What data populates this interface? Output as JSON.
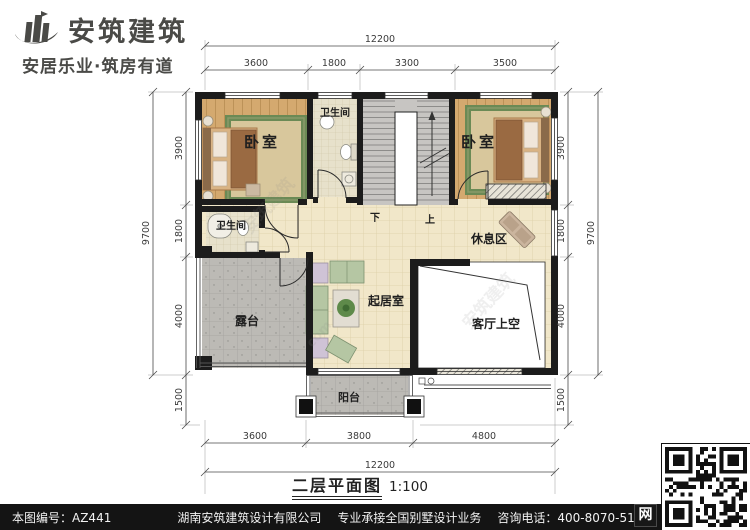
{
  "brand": {
    "name": "安筑建筑",
    "slogan": "安居乐业·筑房有道",
    "logo_color": "#4a4a47"
  },
  "title": {
    "main": "二层平面图",
    "scale": "1:100"
  },
  "plan": {
    "rooms": {
      "bedroom_left": "卧室",
      "bedroom_right": "卧室",
      "bath_top": "卫生间",
      "bath_left": "卫生间",
      "rest_area": "休息区",
      "living": "起居室",
      "terrace": "露台",
      "balcony": "阳台",
      "void_over_living": "客厅上空",
      "stair_down": "下",
      "stair_up": "上"
    },
    "dimensions": {
      "top": {
        "overall": "12200",
        "segments": [
          "3600",
          "1800",
          "3300",
          "3500"
        ]
      },
      "bottom": {
        "overall": "12200",
        "segments": [
          "3600",
          "3800",
          "4800"
        ]
      },
      "left": {
        "overall": "9700",
        "segments": [
          "3900",
          "1800",
          "4000",
          "1500"
        ]
      },
      "right": {
        "overall": "9700",
        "segments": [
          "3900",
          "1800",
          "4000",
          "1500"
        ]
      }
    }
  },
  "watermark": {
    "text": "安筑建筑",
    "suffix": "com"
  },
  "footer": {
    "number": "本图编号：AZ441",
    "company": "湖南安筑建筑设计有限公司",
    "service": "专业承接全国别墅设计业务",
    "phone": "咨询电话：400-8070-511",
    "web": "网"
  },
  "colors": {
    "wall": "#1c1c1c",
    "wood_floor": "#d4a96f",
    "hall_tile": "#f1e7c9",
    "terrace_tile": "#bcbab5",
    "stair": "#c7c5c2",
    "rug_border": "#6b8a55",
    "dim_ink": "#3b3b3b",
    "footer_bg": "#141414"
  }
}
